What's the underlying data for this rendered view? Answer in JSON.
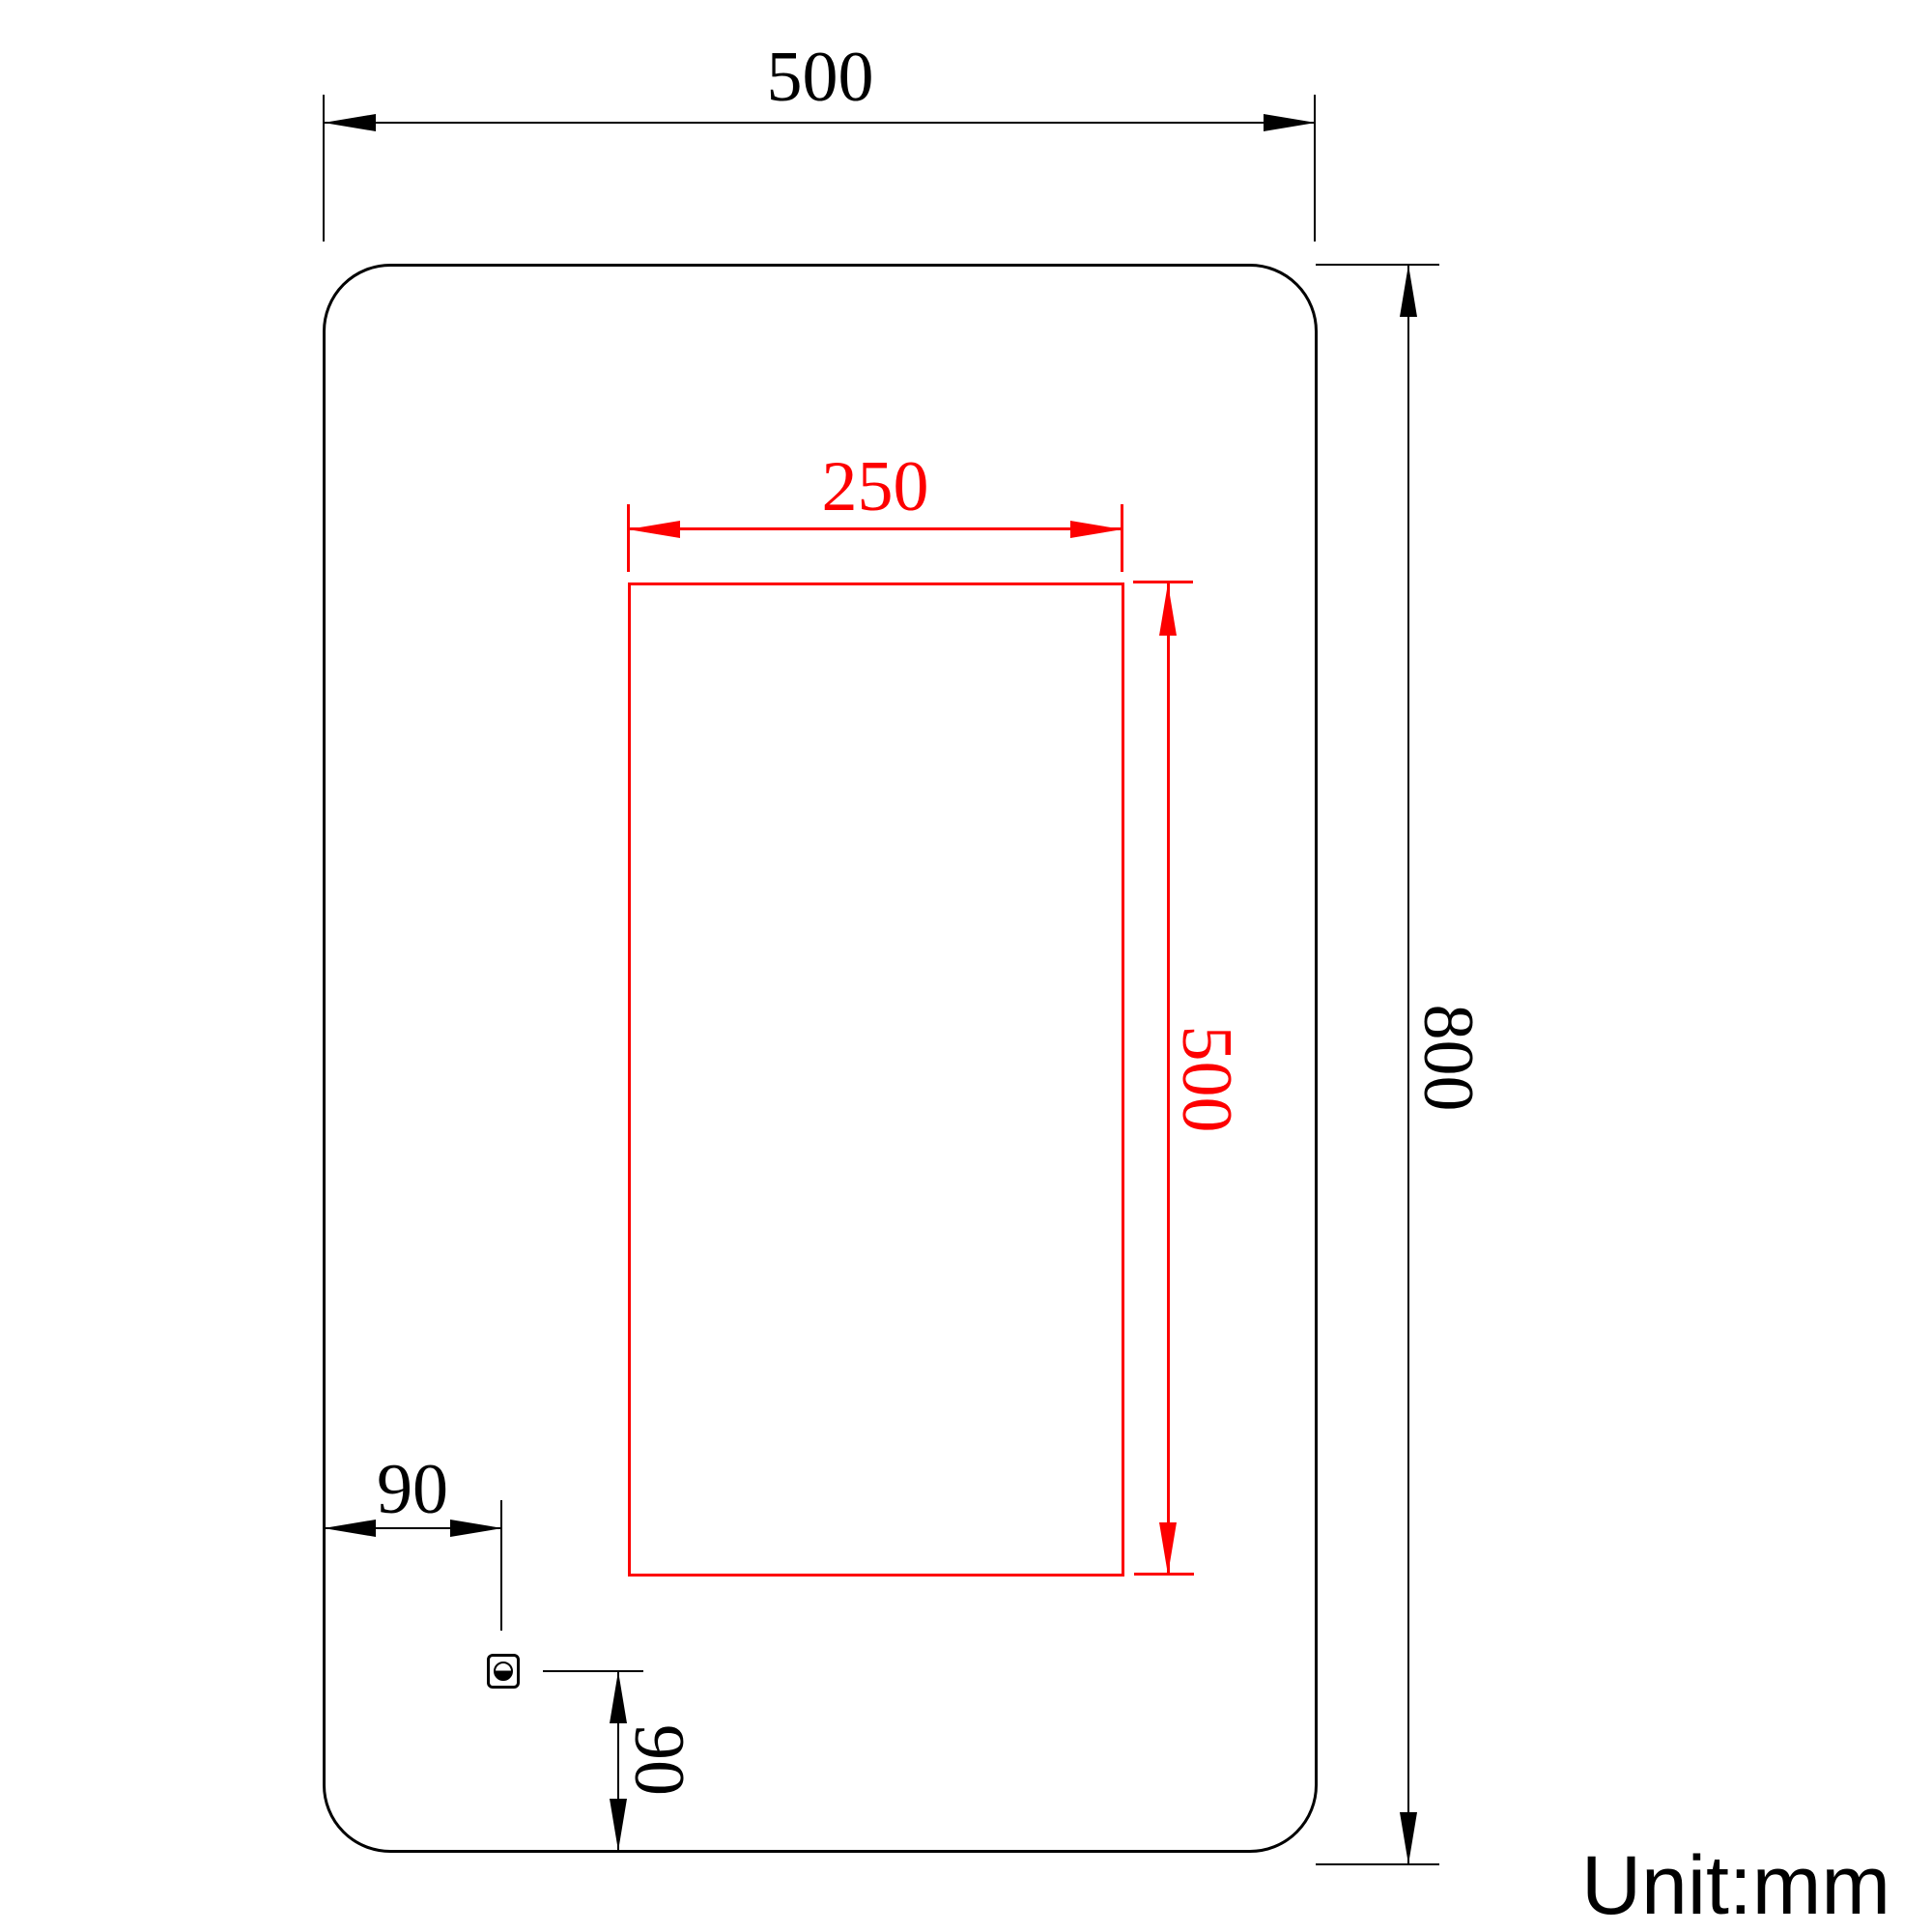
{
  "unit_note": "Unit:mm",
  "dimensions": {
    "outer_width": "500",
    "outer_height": "800",
    "inner_width": "250",
    "inner_height": "500",
    "switch_offset_left": "90",
    "switch_offset_bottom": "90"
  },
  "colors": {
    "primary_line": "#000000",
    "highlight_line": "#fd0000",
    "background": "#ffffff"
  },
  "icons": {
    "switch_symbol": "half-filled-circle-in-square"
  }
}
